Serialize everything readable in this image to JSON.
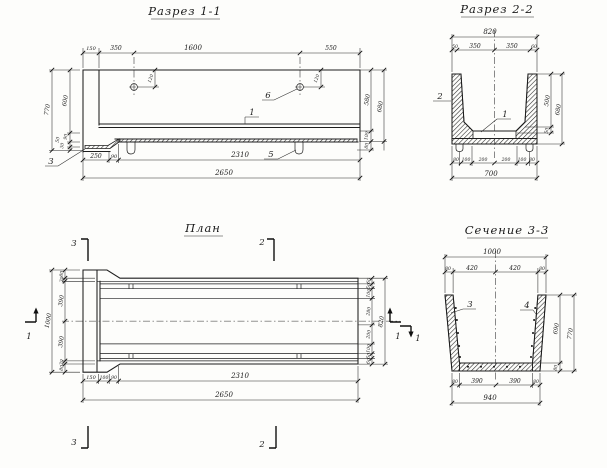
{
  "drawing": {
    "s11": {
      "title": "Разрез 1-1",
      "top": [
        "150",
        "350",
        "1600",
        "550"
      ],
      "hole_left": "120",
      "hole_right": "120",
      "left": {
        "h770": "770",
        "h600": "600",
        "h90": "90",
        "h50": "50",
        "h30": "30"
      },
      "right": {
        "h580": "580",
        "h680": "680",
        "h100": "100",
        "h80": "80"
      },
      "bottom": {
        "d250": "250",
        "d90": "90",
        "d2310": "2310",
        "d2650": "2650"
      },
      "callouts": {
        "c3": "3",
        "c6": "6",
        "c1": "1",
        "c5": "5"
      }
    },
    "s22": {
      "title": "Разрез 2-2",
      "w820": "820",
      "top": [
        "50",
        "350",
        "350",
        "60"
      ],
      "right": {
        "h500": "500",
        "h680": "680",
        "h50": "50"
      },
      "bottom": [
        "80",
        "100",
        "200",
        "200",
        "100",
        "80"
      ],
      "w700": "700",
      "callouts": {
        "c2": "2",
        "c1": "1"
      }
    },
    "plan": {
      "title": "План",
      "left": {
        "h1000": "1000",
        "col": [
          "80",
          "30",
          "390",
          "390",
          "30",
          "80"
        ]
      },
      "right": {
        "h820": "820",
        "col": [
          "60",
          "50",
          "100",
          "280",
          "200",
          "100",
          "50",
          "60"
        ]
      },
      "bottom": {
        "row": [
          "150",
          "100",
          "90"
        ],
        "d2310": "2310",
        "d2650": "2650"
      },
      "markers": {
        "m3t": "3",
        "m2t": "2",
        "m1l": "1",
        "m1r": "1",
        "m3b": "3",
        "m2b": "2"
      }
    },
    "s33": {
      "title": "Сечение 3-3",
      "w1000": "1000",
      "top": [
        "80",
        "420",
        "420",
        "80"
      ],
      "right": {
        "h690": "690",
        "h770": "770",
        "h80": "80"
      },
      "bottom": {
        "row": [
          "80",
          "390",
          "390",
          "80"
        ],
        "w940": "940"
      },
      "callouts": {
        "c3": "3",
        "c4": "4",
        "m1": "1"
      }
    }
  }
}
